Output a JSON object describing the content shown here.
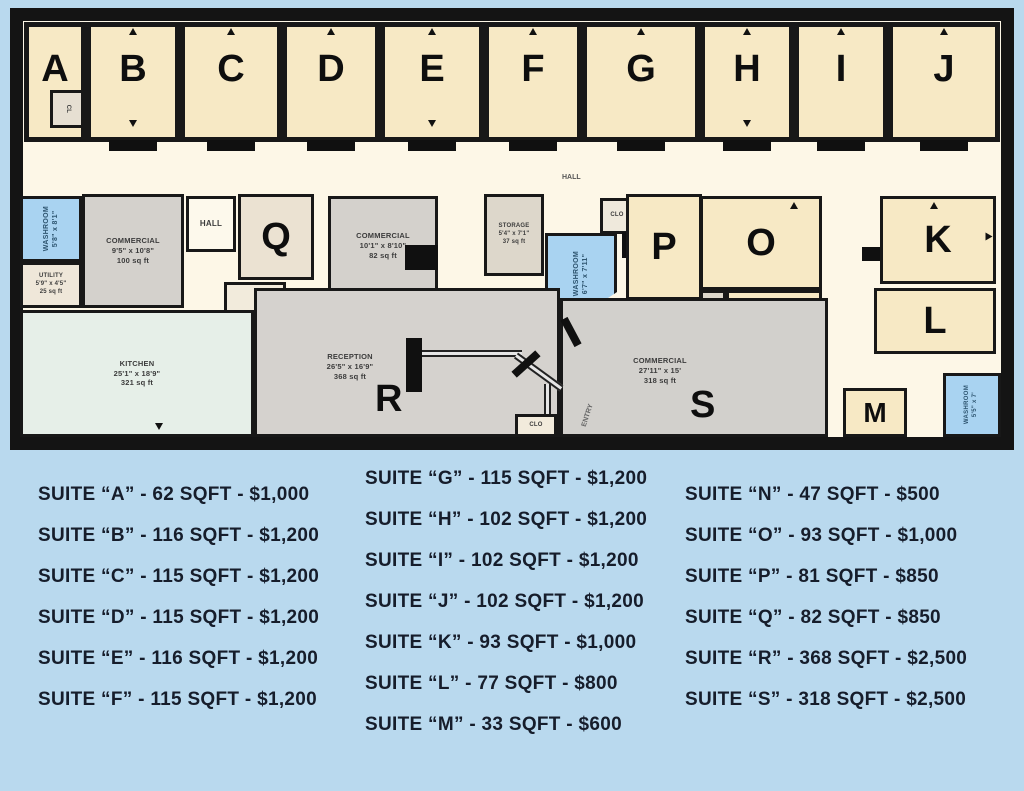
{
  "colors": {
    "page_background": "#b9d9ee",
    "wall": "#141414",
    "suite_cream": "#f7e9c5",
    "corridor": "#fdf7e7",
    "commercial_gray": "#d4d1cc",
    "washroom_blue": "#a9d3f1",
    "kitchen_green": "#e6efe8",
    "listing_text": "#161d2b"
  },
  "plan": {
    "top_suites": [
      {
        "label": "A"
      },
      {
        "label": "B"
      },
      {
        "label": "C"
      },
      {
        "label": "D"
      },
      {
        "label": "E"
      },
      {
        "label": "F"
      },
      {
        "label": "G"
      },
      {
        "label": "H"
      },
      {
        "label": "I"
      },
      {
        "label": "J"
      }
    ],
    "rooms": {
      "cl_closet": {
        "name": "CL"
      },
      "hall_corridor": {
        "name": "HALL"
      },
      "hall_small": {
        "name": "HALL"
      },
      "washroom_left": {
        "name": "WASHROOM",
        "dims": "5'8\" x 8'1\""
      },
      "utility": {
        "name": "UTILITY",
        "dims": "5'9\" x 4'5\"",
        "area": "25 sq ft"
      },
      "commercial_left": {
        "name": "COMMERCIAL",
        "dims": "9'5\" x 10'8\"",
        "area": "100 sq ft"
      },
      "suite_q": {
        "label": "Q"
      },
      "commercial_mid": {
        "name": "COMMERCIAL",
        "dims": "10'1\" x 8'10\"",
        "area": "82 sq ft"
      },
      "storage": {
        "name": "STORAGE",
        "dims": "5'4\" x 7'1\"",
        "area": "37 sq ft"
      },
      "washroom_mid": {
        "name": "WASHROOM",
        "dims": "6'7\" x 7'11\""
      },
      "clo_top": {
        "name": "CLO"
      },
      "suite_p": {
        "label": "P"
      },
      "suite_o": {
        "label": "O"
      },
      "closet_n": {
        "name": "CLOSET"
      },
      "suite_n": {
        "label": "N"
      },
      "suite_k": {
        "label": "K"
      },
      "suite_l": {
        "label": "L"
      },
      "kitchen": {
        "name": "KITCHEN",
        "dims": "25'1\" x 18'9\"",
        "area": "321 sq ft"
      },
      "reception": {
        "name": "RECEPTION",
        "dims": "26'5\" x 16'9\"",
        "area": "368 sq ft",
        "label": "R"
      },
      "commercial_s": {
        "name": "COMMERCIAL",
        "dims": "27'11\" x 15'",
        "area": "318 sq ft",
        "label": "S"
      },
      "clo_bottom": {
        "name": "CLO"
      },
      "entry": {
        "name": "ENTRY"
      },
      "suite_m": {
        "label": "M"
      },
      "washroom_br": {
        "name": "WASHROOM",
        "dims": "5'5\" x 7'"
      }
    }
  },
  "listings": {
    "col1": [
      "SUITE “A” -  62 SQFT -  $1,000",
      "SUITE “B” - 116 SQFT - $1,200",
      "SUITE “C” - 115 SQFT - $1,200",
      "SUITE “D” - 115 SQFT - $1,200",
      "SUITE “E” - 116 SQFT - $1,200",
      "SUITE “F” - 115 SQFT - $1,200"
    ],
    "col2": [
      "SUITE “G” - 115 SQFT - $1,200",
      "SUITE “H” - 102 SQFT - $1,200",
      "SUITE “I” - 102 SQFT - $1,200",
      "SUITE “J” - 102 SQFT - $1,200",
      "SUITE “K” - 93 SQFT - $1,000",
      "SUITE “L” - 77 SQFT - $800",
      "SUITE “M” - 33 SQFT - $600"
    ],
    "col3": [
      "SUITE “N” - 47 SQFT - $500",
      "SUITE “O” - 93 SQFT - $1,000",
      "SUITE “P” - 81 SQFT - $850",
      "SUITE “Q” - 82 SQFT - $850",
      "SUITE “R” - 368 SQFT - $2,500",
      "SUITE “S” - 318 SQFT - $2,500"
    ]
  }
}
